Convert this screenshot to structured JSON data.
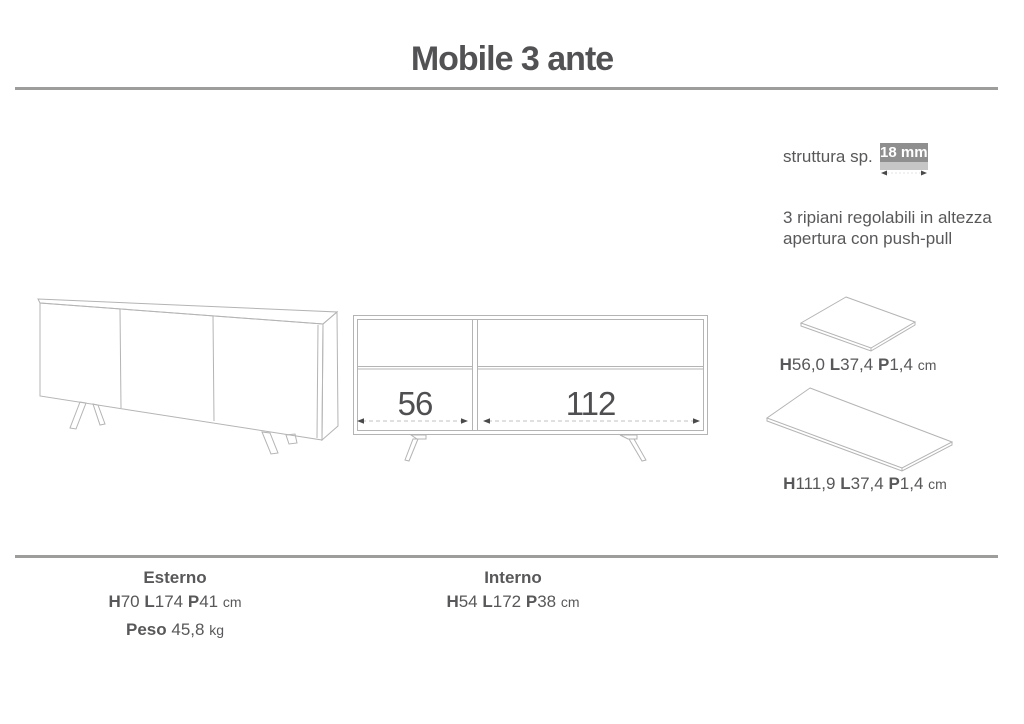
{
  "title": "Mobile 3 ante",
  "specs": {
    "structure_label": "struttura sp.",
    "structure_value": "18 mm",
    "note_line1": "3 ripiani regolabili in altezza",
    "note_line2": "apertura con push-pull"
  },
  "front_view": {
    "left_compartment_width": "56",
    "right_compartment_width": "112"
  },
  "shelves": [
    {
      "h_label": "H",
      "h_value": "56,0",
      "l_label": "L",
      "l_value": "37,4",
      "p_label": "P",
      "p_value": "1,4",
      "unit": "cm"
    },
    {
      "h_label": "H",
      "h_value": "111,9",
      "l_label": "L",
      "l_value": "37,4",
      "p_label": "P",
      "p_value": "1,4",
      "unit": "cm"
    }
  ],
  "footer": {
    "external": {
      "title": "Esterno",
      "h_label": "H",
      "h_value": "70",
      "l_label": "L",
      "l_value": "174",
      "p_label": "P",
      "p_value": "41",
      "unit": "cm",
      "weight_label": "Peso",
      "weight_value": "45,8",
      "weight_unit": "kg"
    },
    "internal": {
      "title": "Interno",
      "h_label": "H",
      "h_value": "54",
      "l_label": "L",
      "l_value": "172",
      "p_label": "P",
      "p_value": "38",
      "unit": "cm"
    }
  },
  "colors": {
    "text": "#58585a",
    "separator_line": "#9d9d9c",
    "drawing_line": "#b4b4b4",
    "dimension_arrow": "#4a4a4c",
    "badge_background": "#8f8f8f",
    "badge_text": "#ffffff",
    "badge_strip": "#c6c6c6"
  }
}
